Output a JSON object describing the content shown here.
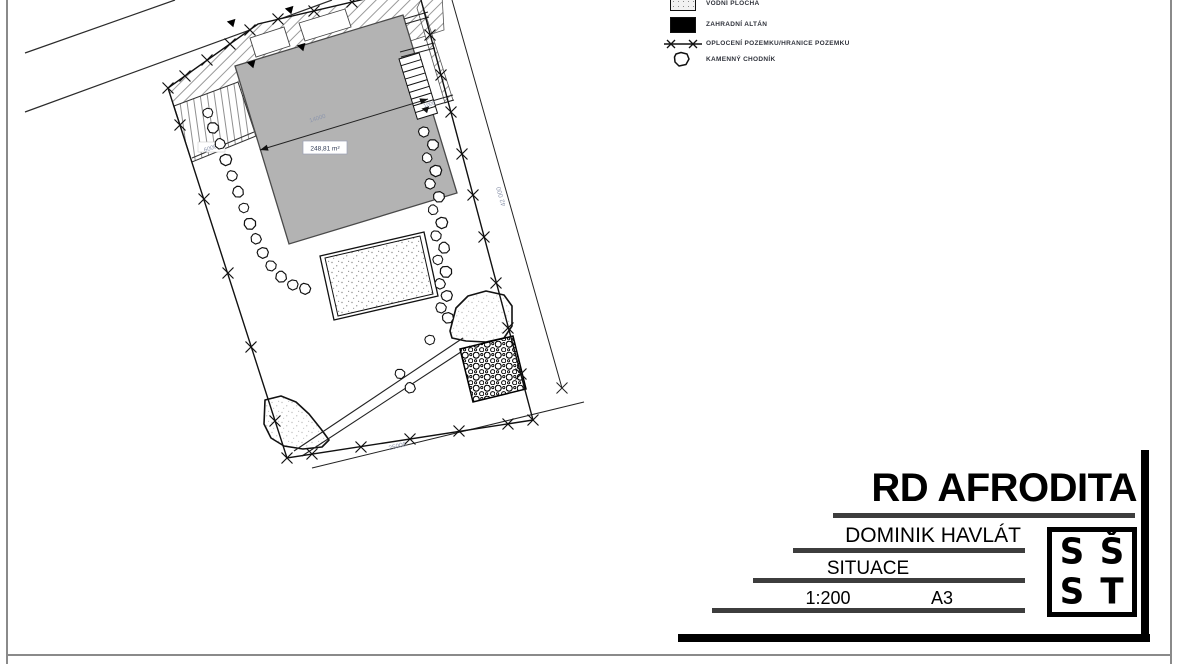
{
  "legend": {
    "items": [
      {
        "name": "water-area",
        "label": "VODNÍ PLOCHA"
      },
      {
        "name": "garden-gazebo",
        "label": "ZAHRADNÍ ALTÁN"
      },
      {
        "name": "fence-boundary",
        "label": "OPLOCENÍ POZEMKU/HRANICE POZEMKU"
      },
      {
        "name": "stone-walkway",
        "label": "KAMENNÝ CHODNÍK"
      }
    ]
  },
  "plan": {
    "building": {
      "area_label": "248,81 m²",
      "width_dimension": "14000"
    },
    "plot": {
      "depth_dimension": "42 000",
      "width_dimension": "25000"
    },
    "driveway_dimension": "6000",
    "stairs_dimension": "1000"
  },
  "title_block": {
    "project_title": "RD AFRODITA",
    "author": "DOMINIK HAVLÁT",
    "drawing_name": "SITUACE",
    "scale": "1:200",
    "paper_format": "A3",
    "logo": {
      "letters": [
        "S",
        "Š",
        "S",
        "T"
      ]
    }
  },
  "colors": {
    "building_fill": "#b3b3b3",
    "underline_bar": "#3d3d3d",
    "frame": "#000000",
    "page_border": "#8a8a8a",
    "dim_text": "#8e97ad"
  }
}
